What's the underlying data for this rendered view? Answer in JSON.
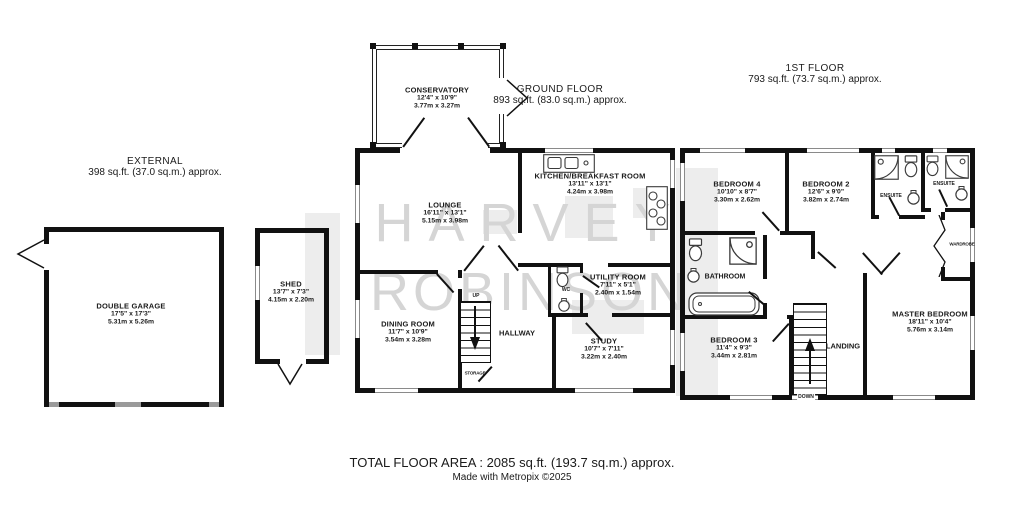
{
  "plan": {
    "headers": {
      "external": {
        "title": "EXTERNAL",
        "area": "398 sq.ft. (37.0 sq.m.) approx."
      },
      "ground_floor": {
        "title": "GROUND FLOOR",
        "area": "893 sq.ft. (83.0 sq.m.) approx."
      },
      "first_floor": {
        "title": "1ST FLOOR",
        "area": "793 sq.ft. (73.7 sq.m.) approx."
      }
    },
    "watermark": {
      "line1": "HARVEY",
      "line2": "ROBINSON"
    },
    "rooms": {
      "conservatory": {
        "name": "CONSERVATORY",
        "imperial": "12'4\" x 10'9\"",
        "metric": "3.77m x 3.27m"
      },
      "lounge": {
        "name": "LOUNGE",
        "imperial": "16'11\" x 13'1\"",
        "metric": "5.15m x 3.98m"
      },
      "kitchen": {
        "name": "KITCHEN/BREAKFAST ROOM",
        "imperial": "13'11\" x 13'1\"",
        "metric": "4.24m x 3.98m"
      },
      "dining": {
        "name": "DINING ROOM",
        "imperial": "11'7\" x 10'9\"",
        "metric": "3.54m x 3.28m"
      },
      "study": {
        "name": "STUDY",
        "imperial": "10'7\" x 7'11\"",
        "metric": "3.22m x 2.40m"
      },
      "utility": {
        "name": "UTILITY ROOM",
        "imperial": "7'11\" x 5'1\"",
        "metric": "2.40m x 1.54m"
      },
      "garage": {
        "name": "DOUBLE GARAGE",
        "imperial": "17'5\" x 17'3\"",
        "metric": "5.31m x 5.26m"
      },
      "shed": {
        "name": "SHED",
        "imperial": "13'7\" x 7'3\"",
        "metric": "4.15m x 2.20m"
      },
      "bedroom2": {
        "name": "BEDROOM 2",
        "imperial": "12'6\" x 9'0\"",
        "metric": "3.82m x 2.74m"
      },
      "bedroom3": {
        "name": "BEDROOM 3",
        "imperial": "11'4\" x 9'3\"",
        "metric": "3.44m x 2.81m"
      },
      "bedroom4": {
        "name": "BEDROOM 4",
        "imperial": "10'10\" x 8'7\"",
        "metric": "3.30m x 2.62m"
      },
      "master": {
        "name": "MASTER BEDROOM",
        "imperial": "18'11\" x 10'4\"",
        "metric": "5.76m x 3.14m"
      }
    },
    "labels": {
      "hallway": "HALLWAY",
      "landing": "LANDING",
      "bathroom": "BATHROOM",
      "ensuite": "ENSUITE",
      "wardrobe": "WARDROBE",
      "wc": "WC",
      "up": "UP",
      "down": "DOWN",
      "storage": "STORAGE"
    },
    "footer": {
      "total": "TOTAL FLOOR AREA : 2085 sq.ft. (193.7 sq.m.) approx.",
      "credit": "Made with Metropix ©2025"
    },
    "colors": {
      "wall": "#111111",
      "watermark": "#d5d5d5",
      "logo_block": "#ededed",
      "window": "#8a8a8a"
    }
  }
}
